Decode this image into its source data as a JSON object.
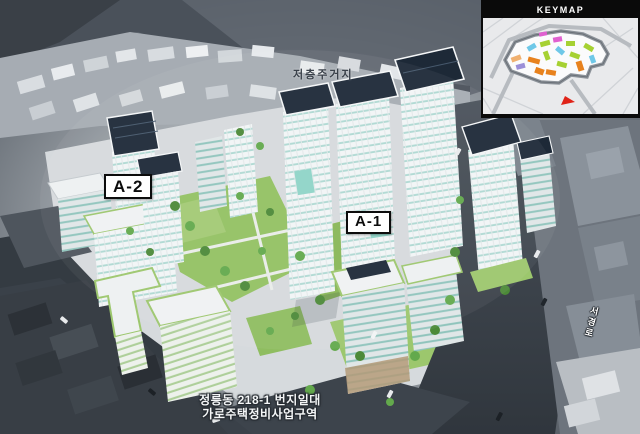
{
  "scene": {
    "upper_area_label": "저층주거지",
    "block_labels": {
      "a2": "A-2",
      "a1": "A-1"
    },
    "road_label": "서경로",
    "caption": {
      "line1": "정릉동 218-1 번지일대",
      "line2": "가로주택정비사업구역"
    }
  },
  "keymap": {
    "title": "KEYMAP"
  },
  "colors": {
    "solar_roof_navy": "#1d2937",
    "facade_white": "#f2f5f6",
    "glass_teal": "#aed9d2",
    "landscape_green": "#93c163",
    "green_roof_trim": "#9cc76d",
    "road_dark": "#3f464f",
    "context_dark": "#383e45",
    "caption_white": "#f4f6f7",
    "keymap_green": "#a6d133",
    "keymap_orange": "#e8821e",
    "keymap_cyan": "#6fc8e8",
    "keymap_magenta": "#e060d0",
    "keymap_purple": "#9b8fd8",
    "keymap_tan": "#f0b070",
    "keymap_arrow_red": "#e02318"
  }
}
